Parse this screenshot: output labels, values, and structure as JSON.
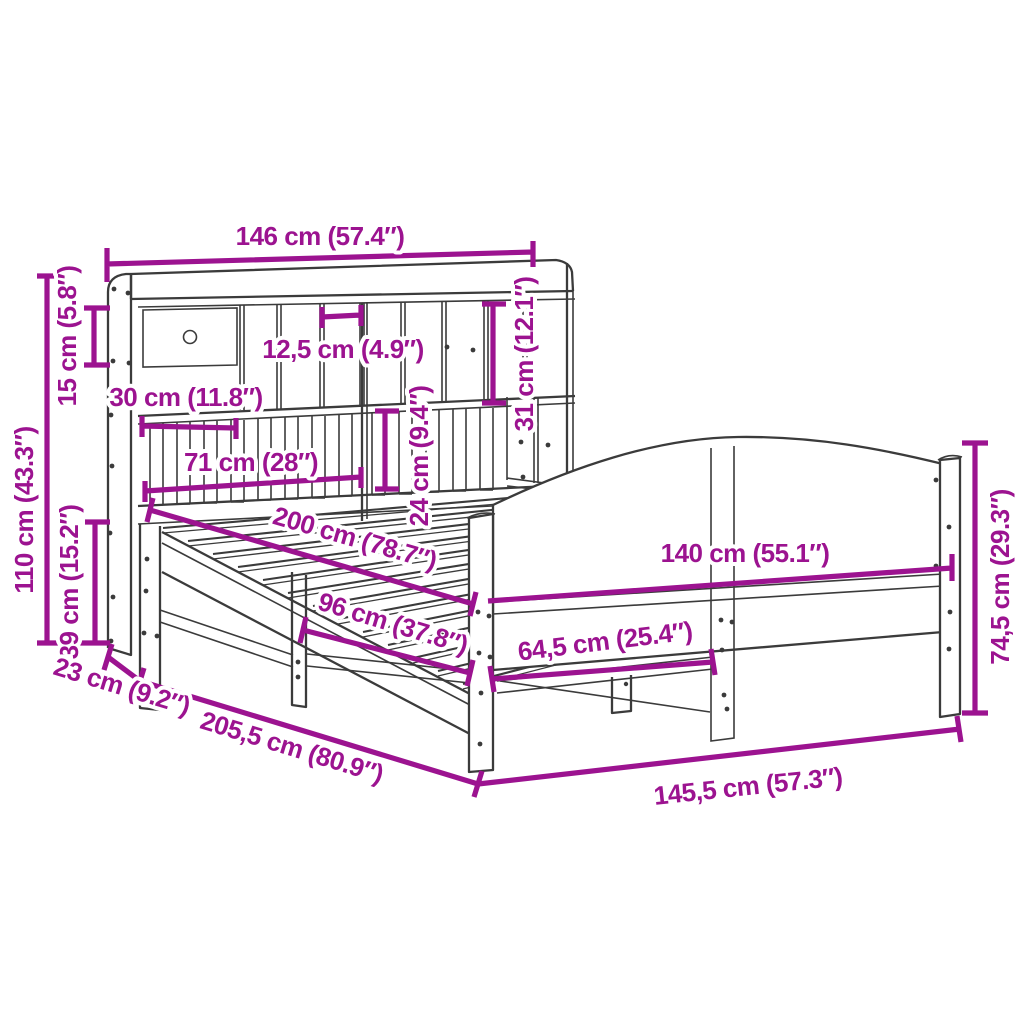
{
  "diagram": {
    "type": "product-dimension-diagram",
    "subject": "bookcase bed frame with headboard shelving and arched footboard",
    "colors": {
      "dimension": "#9c1390",
      "drawing": "#3b3b3b",
      "background": "#ffffff"
    },
    "labels": {
      "total_width": "146 cm (57.4″)",
      "top_shelf_height": "15 cm (5.8″)",
      "headboard_total_height": "110 cm (43.3″)",
      "base_section_height": "39 cm (15.2″)",
      "headboard_depth": "23 cm (9.2″)",
      "total_length": "205,5 cm (80.9″)",
      "compartment_width_30": "30 cm (11.8″)",
      "compartment_width_12_5": "12,5 cm (4.9″)",
      "compartment_width_71": "71 cm (28″)",
      "shelf_opening_height": "31 cm (12.1″)",
      "slat_section_height": "24 cm (9.4″)",
      "mattress_length": "200 cm (78.7″)",
      "mattress_width": "140 cm (55.1″)",
      "leg_spacing": "96 cm (37.8″)",
      "half_frame_width": "64,5 cm (25.4″)",
      "frame_width_total": "145,5 cm (57.3″)",
      "footboard_height": "74,5 cm (29.3″)"
    }
  }
}
